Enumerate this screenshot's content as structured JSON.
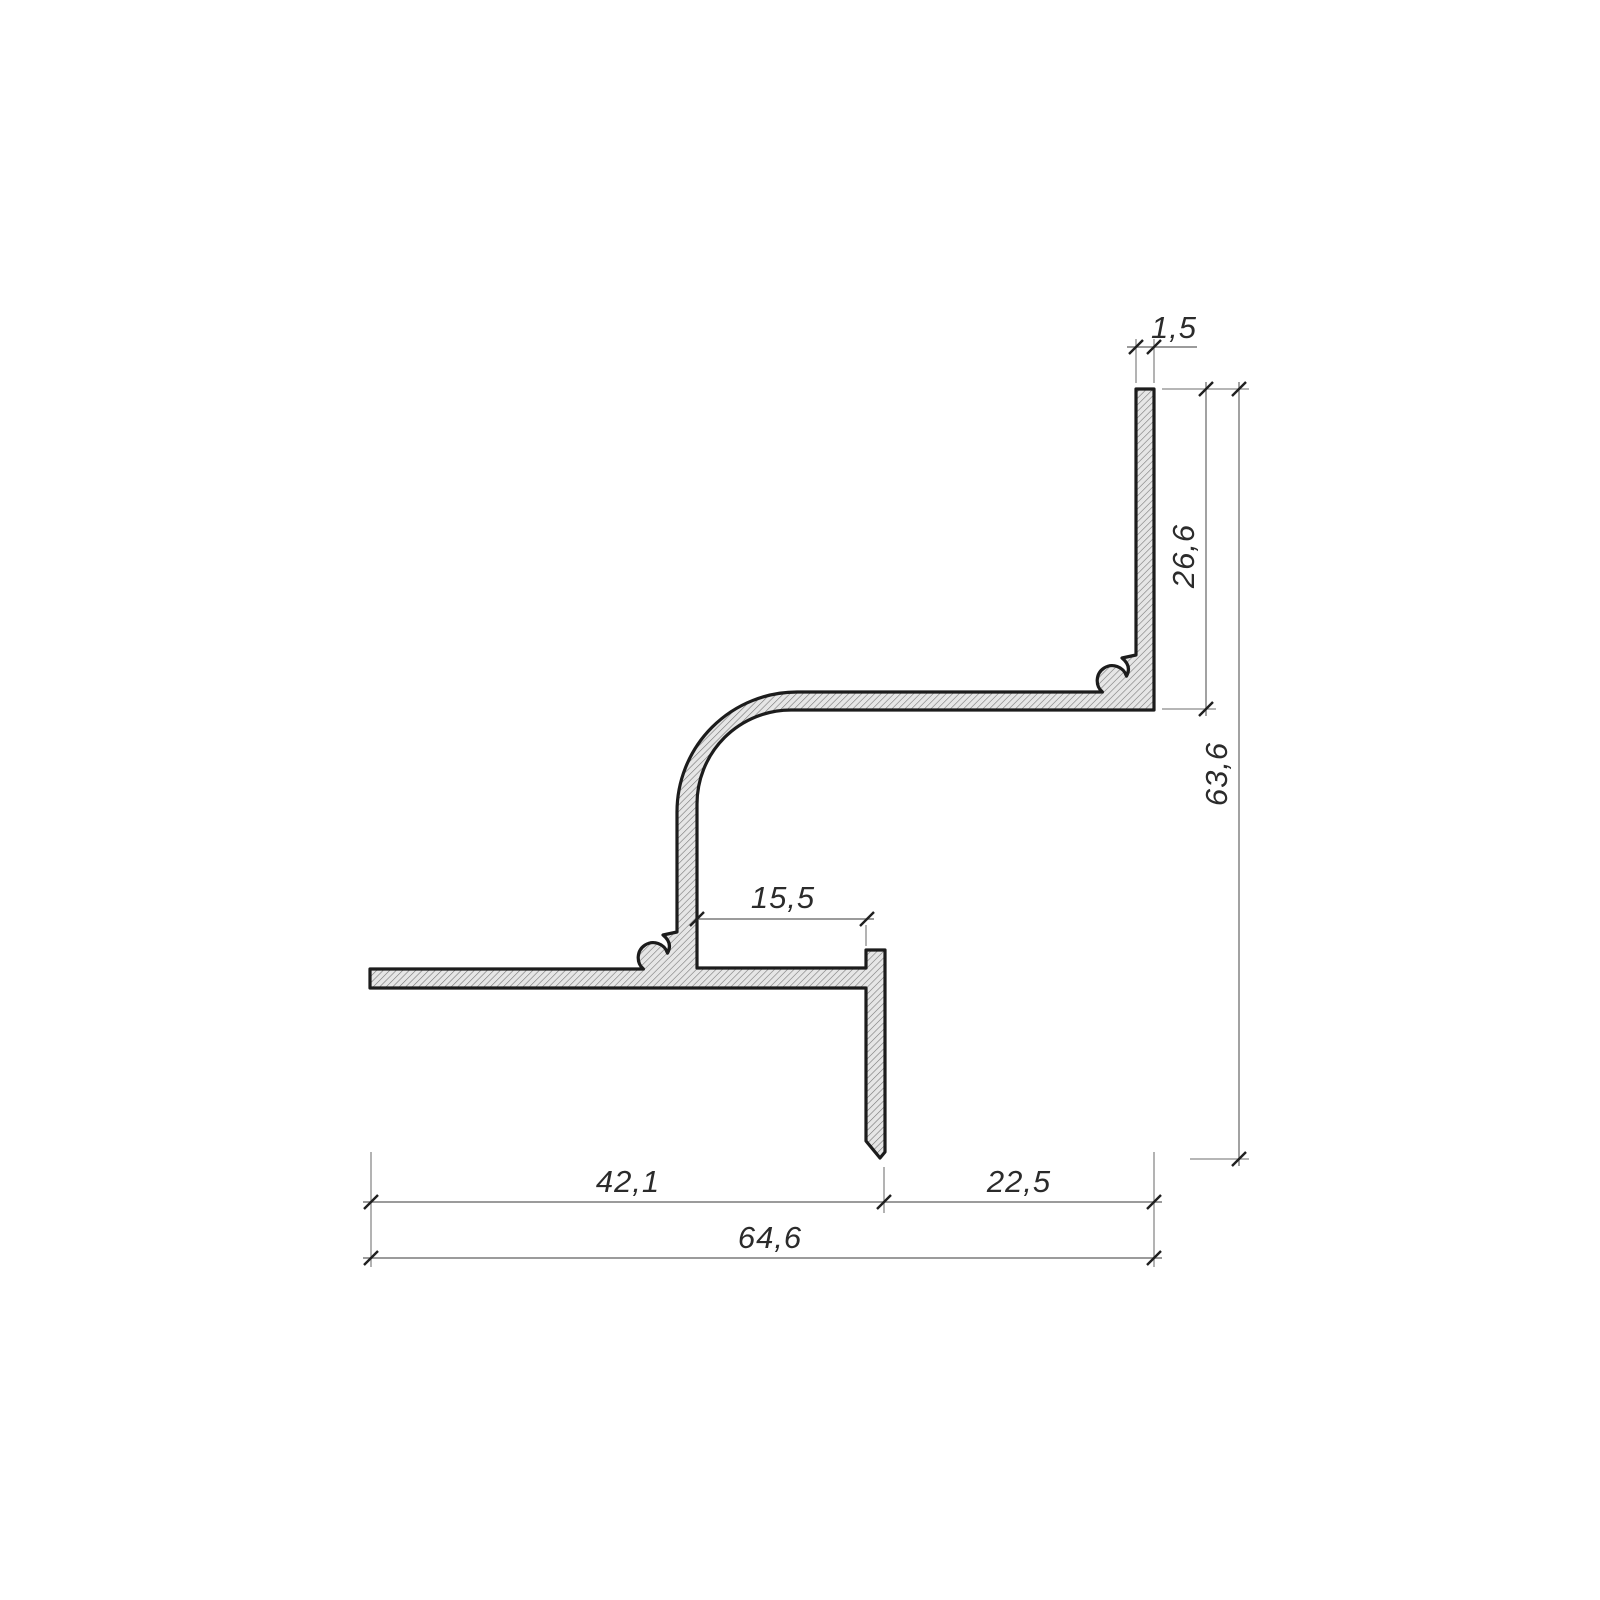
{
  "drawing": {
    "kind": "technical-cross-section",
    "subject": "aluminum-shadow-gap-profile",
    "decimal_style": "comma",
    "dim_labels": {
      "top_thickness": "1,5",
      "upper_right_height": "26,6",
      "total_height": "63,6",
      "inner_gap": "15,5",
      "bottom_left_width": "42,1",
      "bottom_right_width": "22,5",
      "bottom_total_width": "64,6"
    },
    "colors": {
      "paper": "#ffffff",
      "outline": "#1c1c1c",
      "hatch_fill": "#e6e6e6",
      "hatch_line": "#757575",
      "dimension_line": "#7a7a7a",
      "tick": "#202020",
      "label_text": "#2b2b2b"
    }
  }
}
